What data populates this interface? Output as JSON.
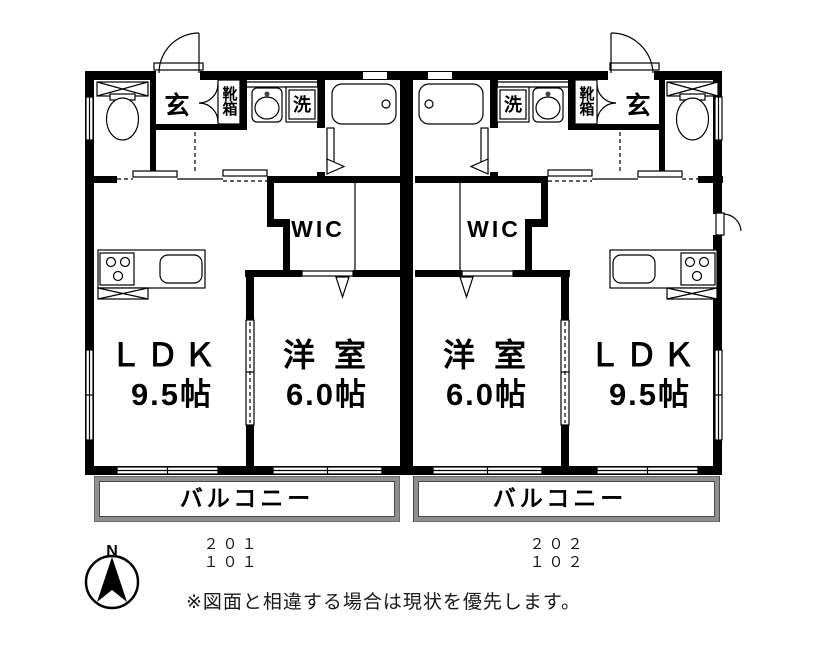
{
  "floorplan": {
    "units": [
      {
        "entrance_label": "玄",
        "shoe_cabinet_label": "靴箱",
        "laundry_label": "洗",
        "wic_label": "WIC",
        "living_label": "ＬＤＫ",
        "living_size": "9.5帖",
        "bedroom_label": "洋 室",
        "bedroom_size": "6.0帖",
        "balcony_label": "バルコニー",
        "unit_numbers": {
          "upper": "２０１",
          "lower": "１０１"
        }
      },
      {
        "entrance_label": "玄",
        "shoe_cabinet_label": "靴箱",
        "laundry_label": "洗",
        "wic_label": "WIC",
        "living_label": "ＬＤＫ",
        "living_size": "9.5帖",
        "bedroom_label": "洋 室",
        "bedroom_size": "6.0帖",
        "balcony_label": "バルコニー",
        "unit_numbers": {
          "upper": "２０２",
          "lower": "１０２"
        }
      }
    ],
    "compass_north_label": "N",
    "disclaimer": "※図面と相違する場合は現状を優先します。"
  }
}
